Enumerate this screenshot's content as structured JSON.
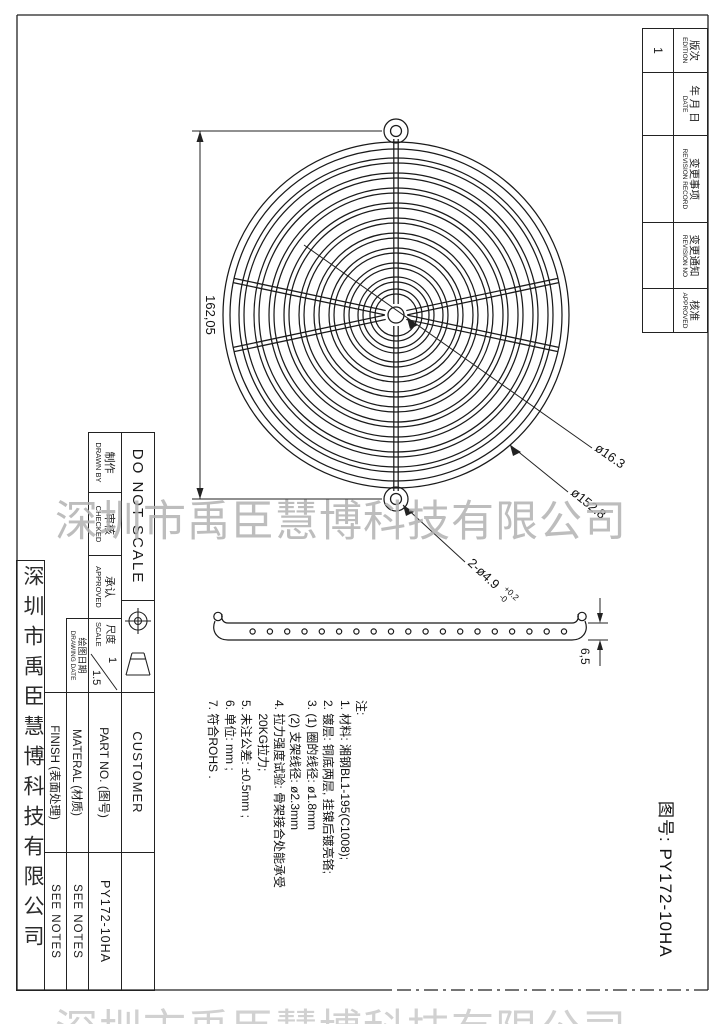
{
  "watermark": {
    "text": "深圳市禹臣慧博科技有限公司"
  },
  "company_strip": {
    "text": "深圳市禹臣慧博科技有限公司"
  },
  "drawing_no": {
    "text": "图号: PY172-10HA"
  },
  "revision_table": {
    "columns": [
      {
        "cn": "版次",
        "en": "EDITION",
        "value": "1"
      },
      {
        "cn": "年 月 日",
        "en": "DATE",
        "value": ""
      },
      {
        "cn": "变更事项",
        "en": "REVISION RECORD",
        "value": ""
      },
      {
        "cn": "变更通知",
        "en": "REVISION NO",
        "value": ""
      },
      {
        "cn": "核准",
        "en": "APPROVED",
        "value": ""
      }
    ]
  },
  "dimensions": {
    "overall": "162,05",
    "hub_dia": "ø16.3",
    "outer_dia": "ø152.8",
    "holes": "2-ø4.9",
    "tol_plus": "+0.2",
    "tol_minus": "-0",
    "thickness": "6,5"
  },
  "notes": {
    "title": "注:",
    "lines": [
      "1. 材料: 湘钢BL1-195(C1008);",
      "2. 镀层: 铜底两层, 挂镍后镀亮铬;",
      "3. (1) 圈的线径: ø1.8mm",
      "    (2) 支架线径: ø2.3mm",
      "4. 拉力强度试验: 骨架接合处能承受",
      "    20KG拉力;",
      "5. 未注公差: ±0.5mm ;",
      "6. 单位: mm ;",
      "7. 符合ROHS ."
    ]
  },
  "title_block": {
    "do_not_scale": "DO NOT SCALE",
    "drawn_by_cn": "制作",
    "drawn_by_en": "DRAWN BY",
    "checked_cn": "审核",
    "checked_en": "CHECKED",
    "approved_cn": "承认",
    "approved_en": "APPROVED",
    "scale_cn": "尺度",
    "scale_en": "SCALE",
    "scale_num": "1",
    "scale_den": "1.5",
    "date_cn": "绘图日期",
    "date_en": "DRAWING DATE",
    "customer_label": "CUSTOMER",
    "part_no_label": "PART NO. (图号)",
    "part_no_value": "PY172-10HA",
    "material_label": "MATERAL (材质)",
    "material_value": "SEE NOTES",
    "finish_label": "FINISH (表面处理)",
    "finish_value": "SEE NOTES"
  }
}
